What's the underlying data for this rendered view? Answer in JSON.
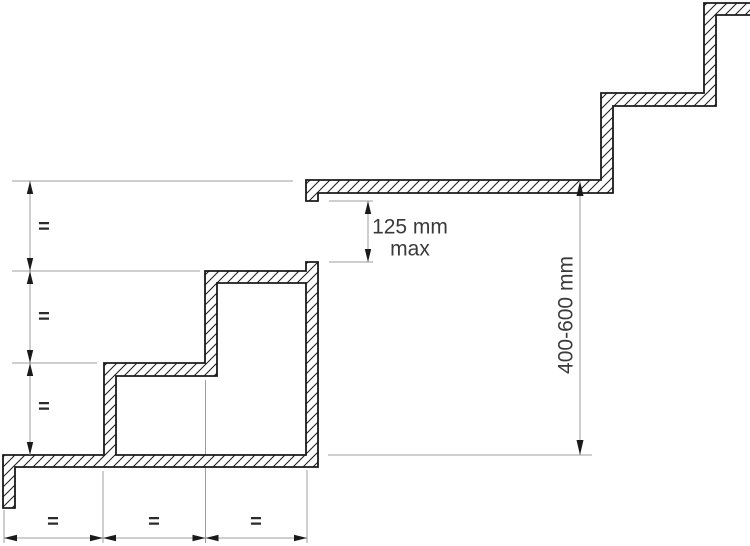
{
  "figure": {
    "type": "technical-diagram",
    "subject": "Stair flights with landing: equal risers and goings, riser-gap and flight-rise limits",
    "colors": {
      "background": "#ffffff",
      "profile_outline": "#1a1a1a",
      "hatch_line": "#1a1a1a",
      "dimension_line": "#9c9c9c",
      "arrowhead": "#1a1a1a",
      "label_text": "#3a3a3a",
      "equal_symbol_text": "#2b2b2b"
    },
    "dimensions": {
      "riser_gap": {
        "value": "125 mm",
        "qualifier": "max"
      },
      "flight_rise": {
        "value": "400-600 mm"
      },
      "equal_rise_labels": [
        "=",
        "=",
        "="
      ],
      "equal_going_labels": [
        "=",
        "=",
        "="
      ]
    }
  }
}
